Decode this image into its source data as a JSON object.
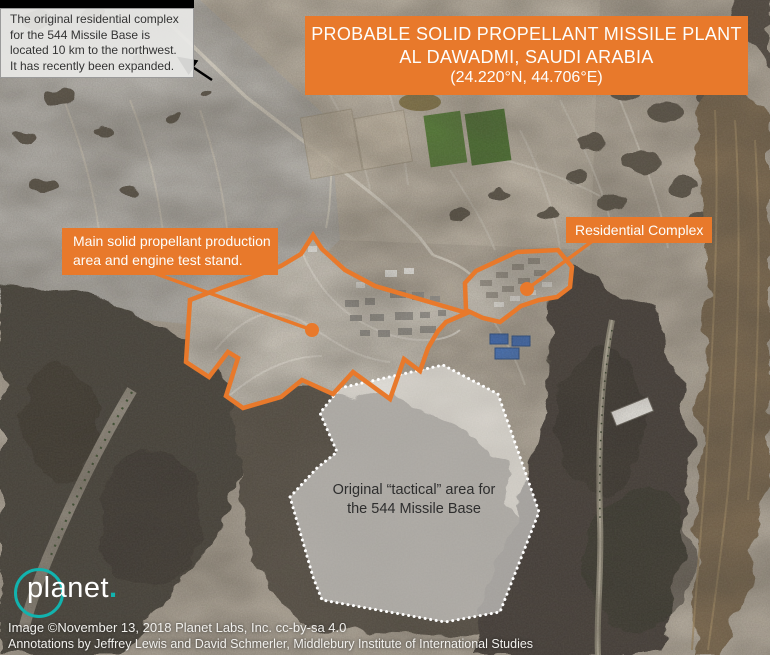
{
  "meta": {
    "width_px": 770,
    "height_px": 655,
    "kind": "annotated satellite image"
  },
  "colors": {
    "accent_orange": "#E8792B",
    "logo_teal": "#12B3AE",
    "overlay_white": "#FFFFFF",
    "callout_text": "#343434",
    "arrow_black": "#000000"
  },
  "callout": {
    "text": "The original residential complex for the 544 Missile Base is located 10 km to the northwest. It has recently been expanded."
  },
  "title_banner": {
    "line1": "PROBABLE SOLID PROPELLANT MISSILE PLANT",
    "line2": "AL DAWADMI, SAUDI ARABIA",
    "line3": "(24.220°N, 44.706°E)"
  },
  "annotations": {
    "main_area": {
      "line1": "Main solid propellant production",
      "line2": "area and engine test stand."
    },
    "residential": {
      "label": "Residential Complex"
    },
    "tactical": {
      "label": "Original “tactical” area for the 544 Missile Base"
    }
  },
  "logo": {
    "wordmark": "planet",
    "dot": "."
  },
  "credits": {
    "line1": "Image ©November 13, 2018 Planet Labs, Inc. cc-by-sa 4.0",
    "line2": "Annotations by Jeffrey Lewis and David Schmerler, Middlebury Institute of International Studies"
  }
}
